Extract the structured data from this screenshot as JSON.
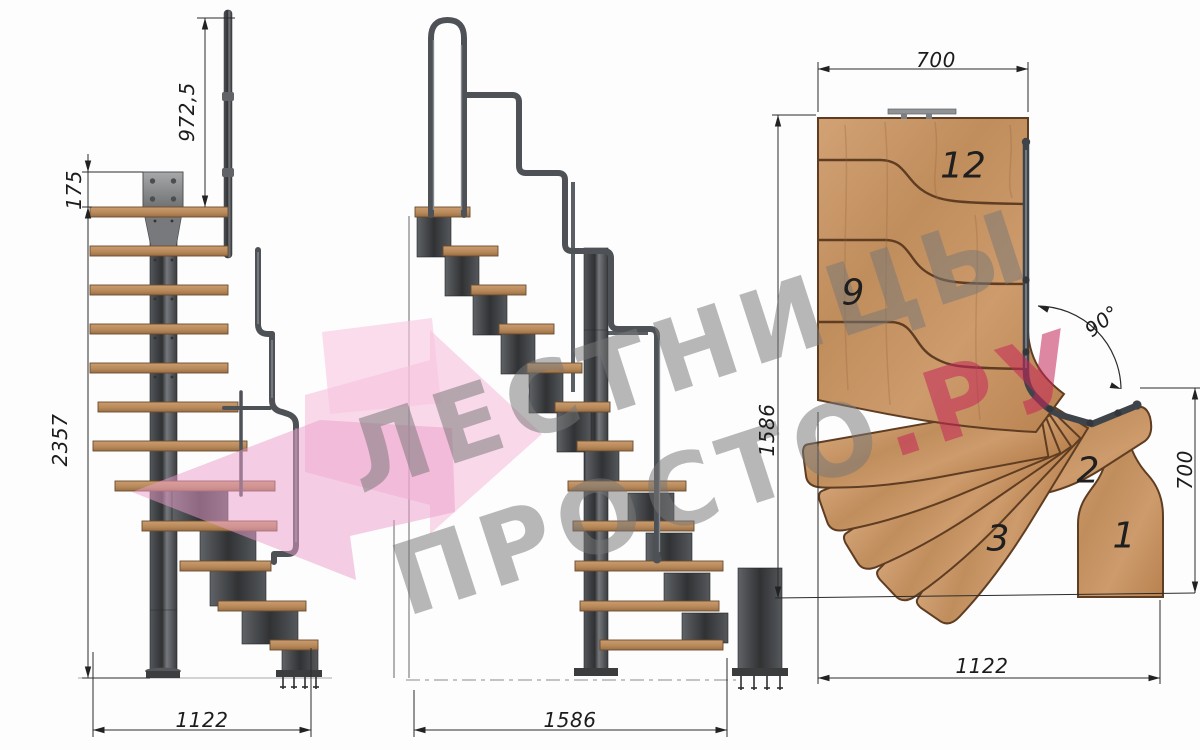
{
  "watermark": {
    "line1": "ЛЕСТНИЦЫ",
    "line2_main": "ПРОСТО",
    "line2_accent": ".РУ",
    "arrow_color": "#f2aed4",
    "text_gray": "#767676",
    "text_pink": "#c4265a"
  },
  "views": {
    "side_elevation": {
      "dims": {
        "handrail_height": "972,5",
        "top_plate_offset": "175",
        "total_height": "2357",
        "footprint_width": "1122"
      }
    },
    "front_elevation": {
      "dims": {
        "footprint_length": "1586"
      }
    },
    "plan": {
      "dims": {
        "top_width": "700",
        "total_length": "1586",
        "turn_angle": "90°",
        "exit_width": "700",
        "bottom_width": "1122"
      },
      "step_labels": {
        "step12": "12",
        "step9": "9",
        "step3": "3",
        "step2": "2",
        "step1": "1"
      }
    }
  },
  "colors": {
    "wood_light": "#d3a376",
    "wood_dark": "#a87a4e",
    "steel_dark": "#2f3134",
    "steel_light": "#76797d",
    "dim_line": "#2b2b2b"
  }
}
